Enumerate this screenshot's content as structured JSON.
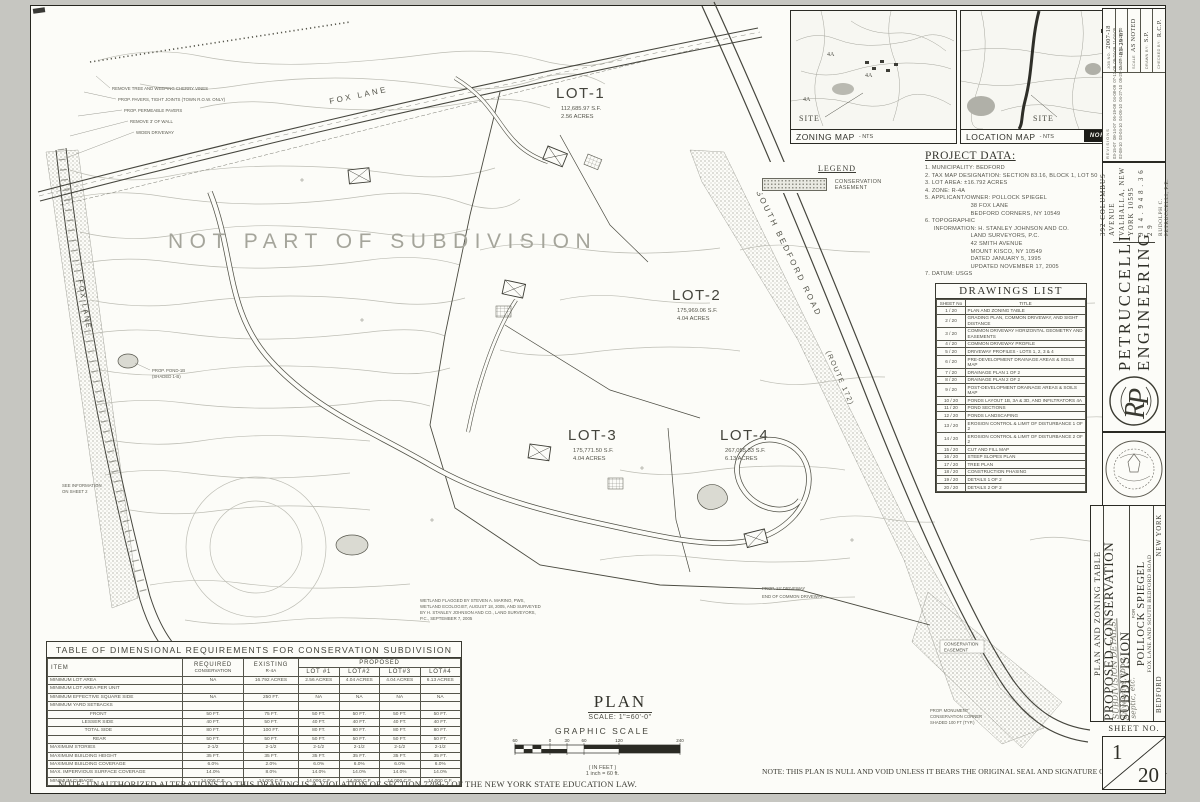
{
  "sheet": {
    "notes": {
      "left": "NOTE: UNAUTHORIZED ALTERATIONS TO THIS DRAWING IS A VIOLATION OF SECTION 7209-2 OF THE NEW YORK STATE EDUCATION LAW.",
      "right": "NOTE: THIS PLAN IS NULL AND VOID UNLESS IT BEARS THE ORIGINAL SEAL AND SIGNATURE OF THE ENGINEER."
    }
  },
  "maps": {
    "zoning": {
      "label": "ZONING MAP",
      "nts": "- NTS",
      "site": "SITE",
      "zones": [
        "4A",
        "4A",
        "4A"
      ]
    },
    "location": {
      "label": "LOCATION MAP",
      "nts": "- NTS",
      "site": "SITE",
      "north": "NORTH"
    }
  },
  "legend": {
    "title": "LEGEND",
    "item": "CONSERVATION EASEMENT"
  },
  "project_data": {
    "title": "PROJECT DATA:",
    "lines": [
      "1. MUNICIPALITY: BEDFORD",
      "2. TAX MAP DESIGNATION: SECTION 83.16, BLOCK 1, LOT 50",
      "3. LOT AREA: ±16.792 ACRES",
      "4. ZONE: R-4A",
      "5. APPLICANT/OWNER: POLLOCK SPIEGEL",
      "                          38 FOX LANE",
      "                          BEDFORD CORNERS, NY 10549",
      "6. TOPOGRAPHIC",
      "     INFORMATION: H. STANLEY JOHNSON AND CO.",
      "                          LAND SURVEYORS, P.C.",
      "                          42 SMITH AVENUE",
      "                          MOUNT KISCO, NY 10549",
      "                          DATED JANUARY 5, 1995",
      "                          UPDATED NOVEMBER 17, 2005",
      "7. DATUM: USGS"
    ]
  },
  "drawings_list": {
    "title": "DRAWINGS LIST",
    "col_no": "SHEET No",
    "col_title": "TITLE",
    "rows": [
      [
        "1 / 20",
        "PLAN AND ZONING TABLE"
      ],
      [
        "2 / 20",
        "GRADING PLAN, COMMON DRIVEWAY, AND SIGHT DISTANCE"
      ],
      [
        "3 / 20",
        "COMMON DRIVEWAY HORIZONTAL GEOMETRY AND EASEMENTS"
      ],
      [
        "4 / 20",
        "COMMON DRIVEWAY PROFILE"
      ],
      [
        "5 / 20",
        "DRIVEWAY PROFILES - LOTS 1, 2, 3 & 4"
      ],
      [
        "6 / 20",
        "PRE-DEVELOPMENT DRAINAGE AREAS & SOILS MAP"
      ],
      [
        "7 / 20",
        "DRAINAGE PLAN 1 OF 2"
      ],
      [
        "8 / 20",
        "DRAINAGE PLAN 2 OF 2"
      ],
      [
        "9 / 20",
        "POST-DEVELOPMENT DRAINAGE AREAS & SOILS MAP"
      ],
      [
        "10 / 20",
        "PONDS LAYOUT 1B, 3A & 3D, AND INFILTRATORS 4A"
      ],
      [
        "11 / 20",
        "POND SECTIONS"
      ],
      [
        "12 / 20",
        "PONDS LANDSCAPING"
      ],
      [
        "13 / 20",
        "EROSION CONTROL & LIMIT OF DISTURBANCE 1 OF 2"
      ],
      [
        "14 / 20",
        "EROSION CONTROL & LIMIT OF DISTURBANCE 2 OF 2"
      ],
      [
        "15 / 20",
        "CUT AND FILL MAP"
      ],
      [
        "16 / 20",
        "STEEP SLOPES PLAN"
      ],
      [
        "17 / 20",
        "TREE PLAN"
      ],
      [
        "18 / 20",
        "CONSTRUCTION PHASING"
      ],
      [
        "19 / 20",
        "DETAILS 1 OF 2"
      ],
      [
        "20 / 20",
        "DETAILS 2 OF 2"
      ]
    ]
  },
  "dim_table": {
    "title": "TABLE OF DIMENSIONAL REQUIREMENTS FOR CONSERVATION SUBDIVISION",
    "col_item": "ITEM",
    "col_req1": "REQUIRED",
    "col_req2": "CONSERVATION",
    "col_ex1": "EXISTING",
    "col_ex2": "R-4A",
    "col_prop": "PROPOSED",
    "lots": [
      "LOT #1",
      "LOT#2",
      "LOT#3",
      "LOT#4"
    ],
    "rows": [
      [
        "MINIMUM LOT AREA",
        "NA",
        "16.792 ACRES",
        "2.56 ACRES",
        "4.04 ACRES",
        "4.04 ACRES",
        "6.13 ACRES"
      ],
      [
        "MINIMUM LOT AREA PER UNIT",
        "",
        "",
        "",
        "",
        "",
        ""
      ],
      [
        "MINIMUM EFFECTIVE SQUARE SIDE",
        "NA",
        "250 FT.",
        "NA",
        "NA",
        "NA",
        "NA"
      ],
      [
        "MINIMUM YARD SETBACKS",
        "",
        "",
        "",
        "",
        "",
        ""
      ],
      [
        "                              FRONT",
        "50 FT.",
        "75 FT.",
        "50 FT.",
        "50 FT.",
        "50 FT.",
        "50 FT."
      ],
      [
        "                        LESSER SIDE",
        "40 FT.",
        "50 FT.",
        "40 FT.",
        "40 FT.",
        "40 FT.",
        "40 FT."
      ],
      [
        "                          TOTAL SIDE",
        "80 FT.",
        "100 FT.",
        "80 FT.",
        "80 FT.",
        "80 FT.",
        "80 FT."
      ],
      [
        "                                REAR",
        "50 FT.",
        "50 FT.",
        "50 FT.",
        "50 FT.",
        "50 FT.",
        "50 FT."
      ],
      [
        "MAXIMUM STORIES",
        "2-1/2",
        "2-1/2",
        "2-1/2",
        "2-1/2",
        "2-1/2",
        "2-1/2"
      ],
      [
        "MAXIMUM BUILDING HEIGHT",
        "35 FT.",
        "35 FT.",
        "35 FT.",
        "35 FT.",
        "35 FT.",
        "35 FT."
      ],
      [
        "MAXIMUM BUILDING COVERAGE",
        "6.0%",
        "2.0%",
        "6.0%",
        "6.0%",
        "6.0%",
        "6.0%"
      ],
      [
        "MAX. IMPERVIOUS SURFACE COVERAGE",
        "14.0%",
        "8.0%",
        "14.0%",
        "14.0%",
        "14.0%",
        "14.0%"
      ],
      [
        "MINIMUM CUBAGE",
        "14,000 C.F.",
        "14,000 C.F.",
        "14,000 C.F.",
        "14,000 C.F.",
        "14,000 C.F.",
        "14,000 C.F."
      ]
    ]
  },
  "plan_block": {
    "title": "PLAN",
    "scale": "SCALE: 1\"=60'-0\"",
    "graphic": "GRAPHIC SCALE",
    "in_feet": "( IN FEET )",
    "inch_eq": "1 inch = 60 ft.",
    "ticks": [
      "60",
      "0",
      "30",
      "60",
      "120",
      "240"
    ]
  },
  "title_block": {
    "job_label": "JOB NO.",
    "job": "2007-18",
    "date_label": "DATE",
    "date": "03-29-07",
    "scale_label": "SCALE",
    "scale": "AS NOTED",
    "drawn_label": "DRAWN BY:",
    "drawn": "S.P.",
    "checked_label": "CHECKED BY:",
    "checked": "R.C.P.",
    "revisions_label": "REVISIONS",
    "revisions_row1": "03-15-07  08-14-07  06-19-08  04-08-09  07-13-09  09-24-09  11-04-09",
    "revisions_row2": "02-08-10  03-04-10  04-05-10  04-27-10  05-25-10  07-13-10  10-20-10",
    "firm_name1": "PETRUCCELLI",
    "firm_name2": "ENGINEERING",
    "firm_addr1": "392 COLUMBUS AVENUE",
    "firm_addr2": "VALHALLA, NEW YORK 10595",
    "firm_phone": "9 1 4 . 9 4 8 . 3 6 2 9",
    "firm_engineer": "RUDOLPH C. PETRUCCELLI, P.E.",
    "col_title": "PLAN AND ZONING TABLE",
    "project_title": "PROPOSED CONSERVATION SUBDIVISION",
    "for_label": "FOR",
    "client": "POLLOCK SPIEGEL",
    "location_line": "FOX LANE  AND  SOUTH BEDFORD ROAD",
    "town": "BEDFORD",
    "state": "NEW YORK",
    "hw1": "SUBDIVISION DETAILS:",
    "hw2": "driveways, topo,",
    "hw3": "septic, etc.",
    "sheet_no_label": "SHEET NO.",
    "sheet_no": "1",
    "sheet_total": "20"
  },
  "plan": {
    "not_part": "NOT PART OF SUBDIVISION",
    "fox_lane": "FOX LANE",
    "fox_lane_left": "FOX LANE",
    "south_bedford": "SOUTH BEDFORD ROAD",
    "route": "(ROUTE 172)",
    "lots": [
      {
        "name": "LOT-1",
        "sf": "112,685.97 S.F.",
        "acres": "2.56 ACRES"
      },
      {
        "name": "LOT-2",
        "sf": "175,969.06 S.F.",
        "acres": "4.04 ACRES"
      },
      {
        "name": "LOT-3",
        "sf": "175,771.50 S.F.",
        "acres": "4.04 ACRES"
      },
      {
        "name": "LOT-4",
        "sf": "267,055.33 S.F.",
        "acres": "6.13 ACRES"
      }
    ],
    "callouts": [
      "REMOVE TREE AND WEEPING CHERRY VINES",
      "PROP. PAVERS, TIGHT JOINTS (TOWN R.O.W. ONLY)",
      "PROP. PERMEABLE PAVERS",
      "REMOVE 3' OF WALL",
      "WIDEN DRIVEWAY"
    ],
    "pond_callout1": "PROP. POND-1B",
    "pond_callout2": "(SHADED 1-B)",
    "see_info1": "SEE INFORMATION",
    "see_info2": "ON SHEET 2",
    "end_drive": "END OF COMMON DRIVEWAY",
    "prop_drive": "PROP. 12' DRIVEWAY",
    "wetland1": "WETLAND FLAGGED BY STEVEN A. MARINO, PWS,",
    "wetland2": "WETLAND ECOLOGIST, AUGUST 18, 2005, AND SURVEYED",
    "wetland3": "BY H. STANLEY JOHNSON AND CO., LAND SURVEYORS,",
    "wetland4": "P.C., SEPTEMBER 7, 2005",
    "monument1": "PROP. MONUMENT",
    "monument2": "CONSERVATION CORNER",
    "monument3": "SHADED 100 FT (TYP.)",
    "easement1": "CONSERVATION",
    "easement2": "EASEMENT"
  }
}
